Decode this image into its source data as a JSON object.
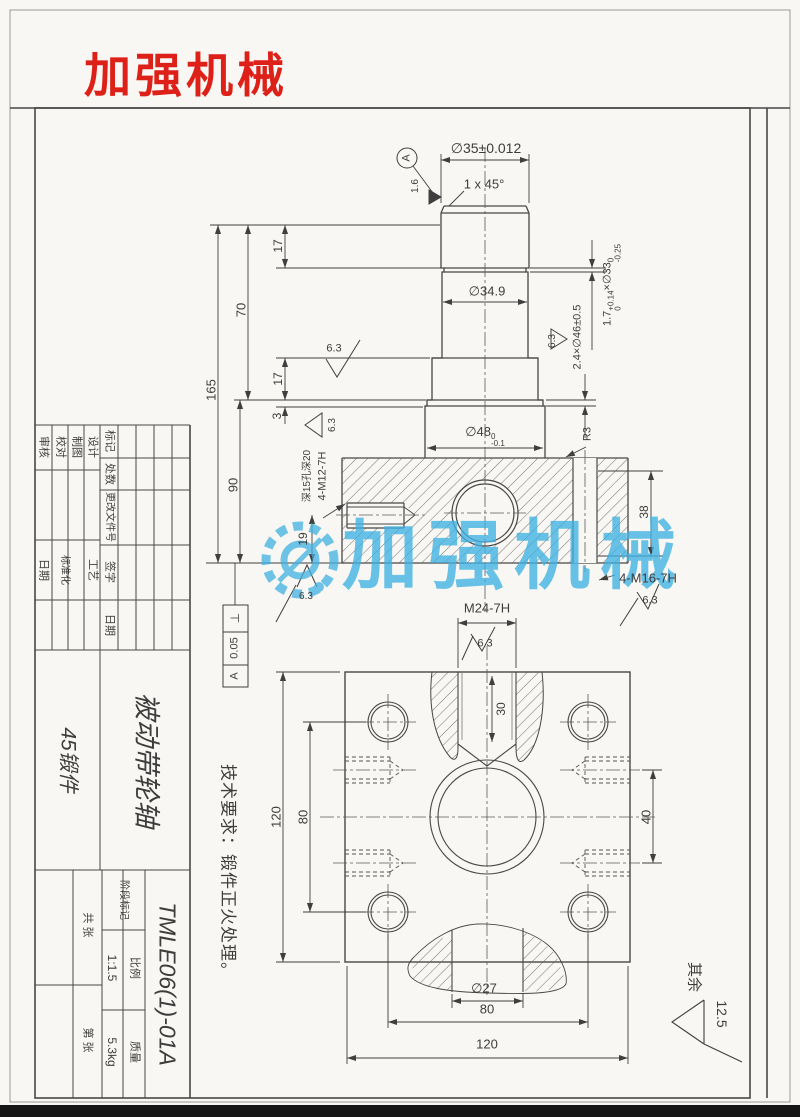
{
  "brand": {
    "logo_text": "加强机械",
    "watermark_text": "加强机械",
    "logo_color": "#dd2018",
    "watermark_color": "#3fb1e2"
  },
  "front_view": {
    "dia35": "∅35±0.012",
    "chamfer": "1 x 45°",
    "dia349": "∅34.9",
    "groove1": {
      "pre": "1.7",
      "sup": "+0.14",
      "sub": "0",
      "post": "×∅33",
      "sup2": "0",
      "sub2": "-0.25"
    },
    "groove2": "2.4×∅46±0.5",
    "dia48": {
      "pre": "∅48",
      "sup": "0",
      "sub": "-0.1"
    },
    "dim_165": "165",
    "dim_70": "70",
    "dim_17_top": "17",
    "dim_17_mid": "17",
    "dim_3": "3",
    "dim_90": "90",
    "dim_19": "19",
    "dim_38": "38",
    "radius_r3": "R3",
    "thread_side": "4-M12-7H",
    "thread_side_note": "深15孔深20",
    "thread_corner": "4-M16-7H",
    "datum": "A",
    "rough_16": "1.6",
    "rough_63": "6.3",
    "tol": {
      "sym": "⊥",
      "val": "0.05",
      "ref": "A"
    }
  },
  "bottom_view": {
    "thread_center": "M24-7H",
    "dim_30": "30",
    "dim_40": "40",
    "dim_80_v": "80",
    "dim_120_v": "120",
    "dim_80_h": "80",
    "dim_120_h": "120",
    "dia27": "∅27"
  },
  "notes": {
    "tech_req": "技术要求：锻件正火处理。",
    "other_label": "其余",
    "other_value": "12.5"
  },
  "title_block": {
    "rev_headers": [
      "标记",
      "处数",
      "更改文件号",
      "签字",
      "日期"
    ],
    "role_audit": "审核",
    "role_check": "校对",
    "role_draft": "制图",
    "role_design": "设计",
    "role_process": "工艺",
    "role_standard": "标准化",
    "label_date": "日期",
    "material": "45锻件",
    "part_name": "被动带轮轴",
    "drawing_no": "TMLE06(1)-01A",
    "stage_label": "阶段标记",
    "scale_label": "比例",
    "scale_value": "1:1.5",
    "mass_label": "质量",
    "mass_value": "5.3kg",
    "sheet_total": "共 张",
    "sheet_no": "第 张"
  }
}
